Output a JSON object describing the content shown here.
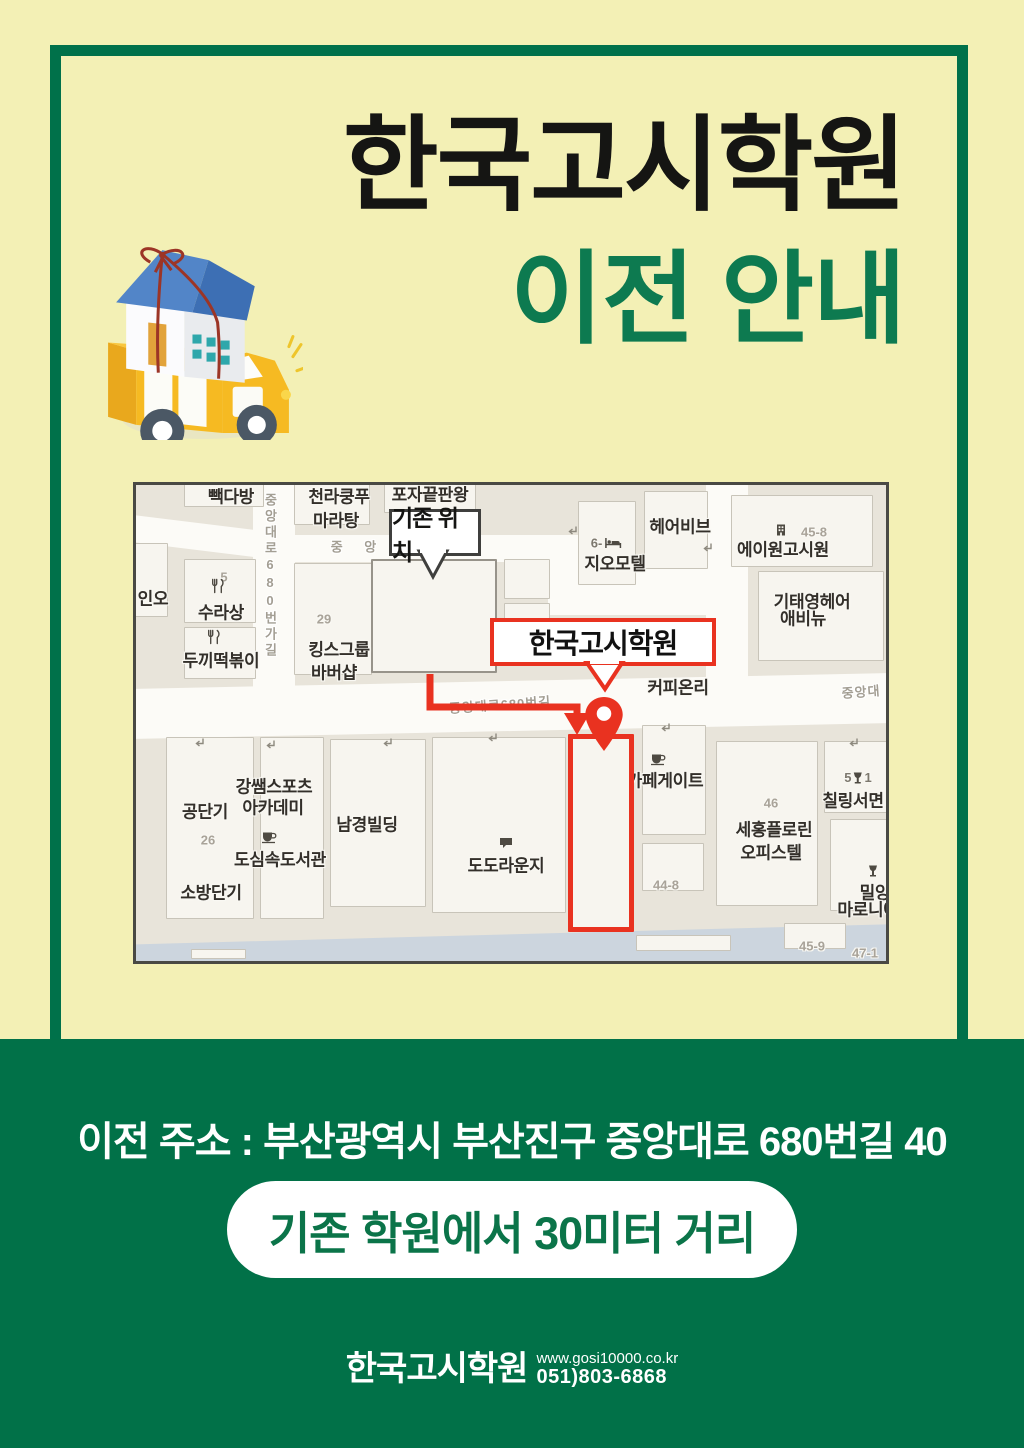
{
  "colors": {
    "background_yellow": "#f3f0b5",
    "brand_green": "#017148",
    "title_green": "#0d7a50",
    "accent_red": "#e93220"
  },
  "header": {
    "title_line1": "한국고시학원",
    "title_line2": "이전 안내"
  },
  "map": {
    "old_location_callout": "기존 위치",
    "new_location_callout": "한국고시학원",
    "streets": {
      "vertical_street": "중앙대로680번가길",
      "top_road": "중 앙",
      "middle_road": "중앙대로680번길",
      "right_road": "중앙대"
    },
    "pois": {
      "baekdabang": "빽다방",
      "chunra_line1": "천라쿵푸",
      "chunra_line2": "마라탕",
      "poja": "포자끝판왕",
      "ino": "인오",
      "num5": "5",
      "surasang": "수라상",
      "ddukki": "두끼떡볶이",
      "num29": "29",
      "kings_line1": "킹스그룹",
      "kings_line2": "바버샵",
      "geo_num": "6-",
      "geomotel": "지오모텔",
      "hairvibe": "헤어비브",
      "num45_8": "45-8",
      "a1gosiwon": "에이원고시원",
      "kitae_line1": "기태영헤어",
      "kitae_line2": "애비뉴",
      "coffeeonly": "커피온리",
      "gongdangi": "공단기",
      "num26": "26",
      "gang_line1": "강쌤스포츠",
      "gang_line2": "아카데미",
      "dosim": "도심속도서관",
      "sobangdangi": "소방단기",
      "namkyung": "남경빌딩",
      "dodo": "도도라운지",
      "cafegate": "카페게이트",
      "num44_8": "44-8",
      "num46": "46",
      "sehong_line1": "세홍플로린",
      "sehong_line2": "오피스텔",
      "chil_num_left": "5",
      "chil_num_right": "1",
      "chilling": "칠링서면",
      "mil_line1": "밀양",
      "mil_line2": "마로니에",
      "num45_9": "45-9",
      "num47_1": "47-1"
    }
  },
  "footer_section": {
    "address": "이전 주소 : 부산광역시 부산진구 중앙대로 680번길 40",
    "distance_badge": "기존 학원에서 30미터 거리",
    "brand": "한국고시학원",
    "website": "www.gosi10000.co.kr",
    "phone": "051)803-6868"
  }
}
